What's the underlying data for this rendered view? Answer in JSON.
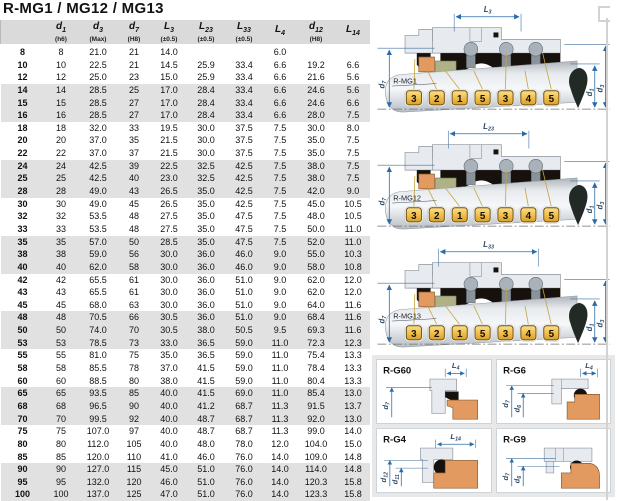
{
  "title": "R-MG1 / MG12 / MG13",
  "table": {
    "columns": [
      {
        "base": "",
        "sub": "",
        "tol": ""
      },
      {
        "base": "d",
        "sub": "1",
        "tol": "(h6)"
      },
      {
        "base": "d",
        "sub": "3",
        "tol": "(Max)"
      },
      {
        "base": "d",
        "sub": "7",
        "tol": "(H8)"
      },
      {
        "base": "L",
        "sub": "3",
        "tol": "(±0.5)"
      },
      {
        "base": "L",
        "sub": "23",
        "tol": "(±0.5)"
      },
      {
        "base": "L",
        "sub": "33",
        "tol": "(±0.5)"
      },
      {
        "base": "L",
        "sub": "4",
        "tol": ""
      },
      {
        "base": "d",
        "sub": "12",
        "tol": "(H8)"
      },
      {
        "base": "L",
        "sub": "14",
        "tol": ""
      }
    ],
    "rows": [
      [
        "8",
        "8",
        "21.0",
        "21",
        "14.0",
        "",
        "",
        "6.0",
        "",
        ""
      ],
      [
        "10",
        "10",
        "22.5",
        "21",
        "14.5",
        "25.9",
        "33.4",
        "6.6",
        "19.2",
        "6.6"
      ],
      [
        "12",
        "12",
        "25.0",
        "23",
        "15.0",
        "25.9",
        "33.4",
        "6.6",
        "21.6",
        "5.6"
      ],
      [
        "14",
        "14",
        "28.5",
        "25",
        "17.0",
        "28.4",
        "33.4",
        "6.6",
        "24.6",
        "5.6"
      ],
      [
        "15",
        "15",
        "28.5",
        "27",
        "17.0",
        "28.4",
        "33.4",
        "6.6",
        "24.6",
        "6.6"
      ],
      [
        "16",
        "16",
        "28.5",
        "27",
        "17.0",
        "28.4",
        "33.4",
        "6.6",
        "28.0",
        "7.5"
      ],
      [
        "18",
        "18",
        "32.0",
        "33",
        "19.5",
        "30.0",
        "37.5",
        "7.5",
        "30.0",
        "8.0"
      ],
      [
        "20",
        "20",
        "37.0",
        "35",
        "21.5",
        "30.0",
        "37.5",
        "7.5",
        "35.0",
        "7.5"
      ],
      [
        "22",
        "22",
        "37.0",
        "37",
        "21.5",
        "30.0",
        "37.5",
        "7.5",
        "35.0",
        "7.5"
      ],
      [
        "24",
        "24",
        "42.5",
        "39",
        "22.5",
        "32.5",
        "42.5",
        "7.5",
        "38.0",
        "7.5"
      ],
      [
        "25",
        "25",
        "42.5",
        "40",
        "23.0",
        "32.5",
        "42.5",
        "7.5",
        "38.0",
        "7.5"
      ],
      [
        "28",
        "28",
        "49.0",
        "43",
        "26.5",
        "35.0",
        "42.5",
        "7.5",
        "42.0",
        "9.0"
      ],
      [
        "30",
        "30",
        "49.0",
        "45",
        "26.5",
        "35.0",
        "42.5",
        "7.5",
        "45.0",
        "10.5"
      ],
      [
        "32",
        "32",
        "53.5",
        "48",
        "27.5",
        "35.0",
        "47.5",
        "7.5",
        "48.0",
        "10.5"
      ],
      [
        "33",
        "33",
        "53.5",
        "48",
        "27.5",
        "35.0",
        "47.5",
        "7.5",
        "50.0",
        "11.0"
      ],
      [
        "35",
        "35",
        "57.0",
        "50",
        "28.5",
        "35.0",
        "47.5",
        "7.5",
        "52.0",
        "11.0"
      ],
      [
        "38",
        "38",
        "59.0",
        "56",
        "30.0",
        "36.0",
        "46.0",
        "9.0",
        "55.0",
        "10.3"
      ],
      [
        "40",
        "40",
        "62.0",
        "58",
        "30.0",
        "36.0",
        "46.0",
        "9.0",
        "58.0",
        "10.8"
      ],
      [
        "42",
        "42",
        "65.5",
        "61",
        "30.0",
        "36.0",
        "51.0",
        "9.0",
        "62.0",
        "12.0"
      ],
      [
        "43",
        "43",
        "65.5",
        "61",
        "30.0",
        "36.0",
        "51.0",
        "9.0",
        "62.0",
        "12.0"
      ],
      [
        "45",
        "45",
        "68.0",
        "63",
        "30.0",
        "36.0",
        "51.0",
        "9.0",
        "64.0",
        "11.6"
      ],
      [
        "48",
        "48",
        "70.5",
        "66",
        "30.5",
        "36.0",
        "51.0",
        "9.0",
        "68.4",
        "11.6"
      ],
      [
        "50",
        "50",
        "74.0",
        "70",
        "30.5",
        "38.0",
        "50.5",
        "9.5",
        "69.3",
        "11.6"
      ],
      [
        "53",
        "53",
        "78.5",
        "73",
        "33.0",
        "36.5",
        "59.0",
        "11.0",
        "72.3",
        "12.3"
      ],
      [
        "55",
        "55",
        "81.0",
        "75",
        "35.0",
        "36.5",
        "59.0",
        "11.0",
        "75.4",
        "13.3"
      ],
      [
        "58",
        "58",
        "85.5",
        "78",
        "37.0",
        "41.5",
        "59.0",
        "11.0",
        "78.4",
        "13.3"
      ],
      [
        "60",
        "60",
        "88.5",
        "80",
        "38.0",
        "41.5",
        "59.0",
        "11.0",
        "80.4",
        "13.3"
      ],
      [
        "65",
        "65",
        "93.5",
        "85",
        "40.0",
        "41.5",
        "69.0",
        "11.0",
        "85.4",
        "13.0"
      ],
      [
        "68",
        "68",
        "96.5",
        "90",
        "40.0",
        "41.2",
        "68.7",
        "11.3",
        "91.5",
        "13.7"
      ],
      [
        "70",
        "70",
        "99.5",
        "92",
        "40.0",
        "48.7",
        "68.7",
        "11.3",
        "92.0",
        "13.0"
      ],
      [
        "75",
        "75",
        "107.0",
        "97",
        "40.0",
        "48.7",
        "68.7",
        "11.3",
        "99.0",
        "14.0"
      ],
      [
        "80",
        "80",
        "112.0",
        "105",
        "40.0",
        "48.0",
        "78.0",
        "12.0",
        "104.0",
        "15.0"
      ],
      [
        "85",
        "85",
        "120.0",
        "110",
        "41.0",
        "46.0",
        "76.0",
        "14.0",
        "109.0",
        "14.8"
      ],
      [
        "90",
        "90",
        "127.0",
        "115",
        "45.0",
        "51.0",
        "76.0",
        "14.0",
        "114.0",
        "14.8"
      ],
      [
        "95",
        "95",
        "132.0",
        "120",
        "46.0",
        "51.0",
        "76.0",
        "14.0",
        "120.3",
        "15.8"
      ],
      [
        "100",
        "100",
        "137.0",
        "125",
        "47.0",
        "51.0",
        "76.0",
        "14.0",
        "123.3",
        "15.8"
      ]
    ]
  },
  "diagrams": [
    {
      "label": "R-MG1",
      "dim_top": {
        "base": "L",
        "sub": "3"
      },
      "dim_left": {
        "base": "d",
        "sub": "7"
      },
      "dims_right": [
        {
          "base": "d",
          "sub": "1"
        },
        {
          "base": "d",
          "sub": "3"
        }
      ],
      "tags": [
        "3",
        "2",
        "1",
        "5",
        "3",
        "4",
        "5"
      ]
    },
    {
      "label": "R-MG12",
      "dim_top": {
        "base": "L",
        "sub": "23"
      },
      "dim_left": {
        "base": "d",
        "sub": "7"
      },
      "dims_right": [
        {
          "base": "d",
          "sub": "1"
        },
        {
          "base": "d",
          "sub": "3"
        }
      ],
      "tags": [
        "3",
        "2",
        "1",
        "5",
        "3",
        "4",
        "5"
      ]
    },
    {
      "label": "R-MG13",
      "dim_top": {
        "base": "L",
        "sub": "33"
      },
      "dim_left": {
        "base": "d",
        "sub": "7"
      },
      "dims_right": [
        {
          "base": "d",
          "sub": "1"
        },
        {
          "base": "d",
          "sub": "3"
        }
      ],
      "tags": [
        "3",
        "2",
        "1",
        "5",
        "3",
        "4",
        "5"
      ]
    }
  ],
  "panels": [
    {
      "label": "R-G60",
      "variant": "g60",
      "dim_top": {
        "base": "L",
        "sub": "4"
      },
      "dims_left": [
        {
          "base": "d",
          "sub": "7"
        }
      ]
    },
    {
      "label": "R-G6",
      "variant": "g6",
      "dim_top": {
        "base": "L",
        "sub": "4"
      },
      "dims_left": [
        {
          "base": "d",
          "sub": "7"
        },
        {
          "base": "d",
          "sub": "6"
        }
      ]
    },
    {
      "label": "R-G4",
      "variant": "g4",
      "dim_top": {
        "base": "L",
        "sub": "14"
      },
      "dims_left": [
        {
          "base": "d",
          "sub": "12"
        },
        {
          "base": "d",
          "sub": "11"
        }
      ]
    },
    {
      "label": "R-G9",
      "variant": "g9",
      "dim_top": null,
      "dims_left": [
        {
          "base": "d",
          "sub": "7"
        },
        {
          "base": "d",
          "sub": "6"
        }
      ]
    }
  ],
  "colors": {
    "dimension_blue": "#2b6ca8",
    "tag_yellow": "#f0c050",
    "part_orange": "#e39a60",
    "part_olive": "#aeb286",
    "body_gray": "#e7eaef",
    "rubber_black": "#16110d",
    "stripe_gray": "#e1e1e1",
    "header_gray": "#dadada"
  }
}
